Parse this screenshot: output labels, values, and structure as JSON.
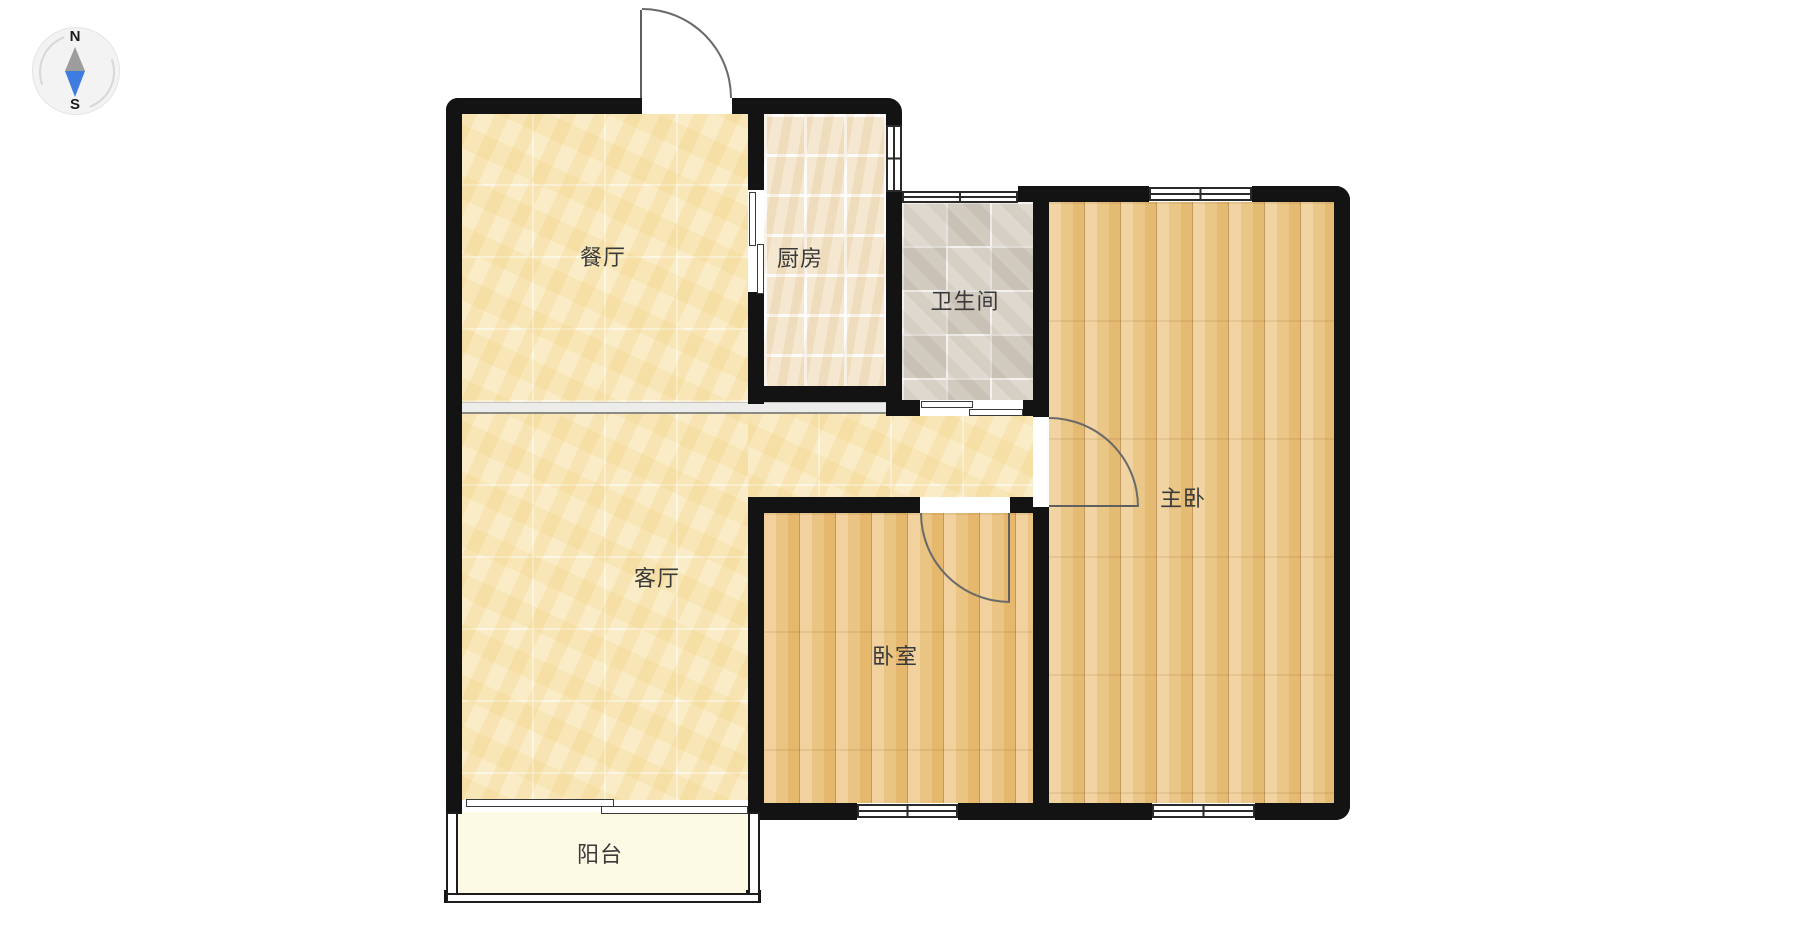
{
  "page": {
    "background": "#ffffff"
  },
  "compass": {
    "north_label": "N",
    "south_label": "S",
    "needle_north_color": "#9d9d9d",
    "needle_south_color": "#3e7ce2"
  },
  "floor_plan": {
    "type": "apartment-floor-plan",
    "wall_color": "#131313",
    "door_line_color": "#6a6a6a",
    "divider_color": "#ececea",
    "rooms": [
      {
        "id": "dining",
        "label": "餐厅",
        "floor": "yellow-marble-tile"
      },
      {
        "id": "kitchen",
        "label": "厨房",
        "floor": "beige-ceramic-tile"
      },
      {
        "id": "bathroom",
        "label": "卫生间",
        "floor": "gray-ceramic-tile"
      },
      {
        "id": "master-bedroom",
        "label": "主卧",
        "floor": "wood-plank"
      },
      {
        "id": "living",
        "label": "客厅",
        "floor": "yellow-marble-tile"
      },
      {
        "id": "bedroom",
        "label": "卧室",
        "floor": "wood-plank"
      },
      {
        "id": "balcony",
        "label": "阳台",
        "floor": "cream"
      }
    ],
    "features": {
      "entry_door": "top wall, swings outward",
      "kitchen_door": "sliding, west wall of kitchen",
      "bathroom_door": "sliding, south wall of bathroom",
      "master_door": "hinged, opens into master bedroom",
      "bedroom_door": "hinged, opens into bedroom",
      "balcony_door": "sliding, south of living room",
      "windows": [
        "kitchen east",
        "bathroom north",
        "master north",
        "bedroom south",
        "master south"
      ]
    }
  }
}
